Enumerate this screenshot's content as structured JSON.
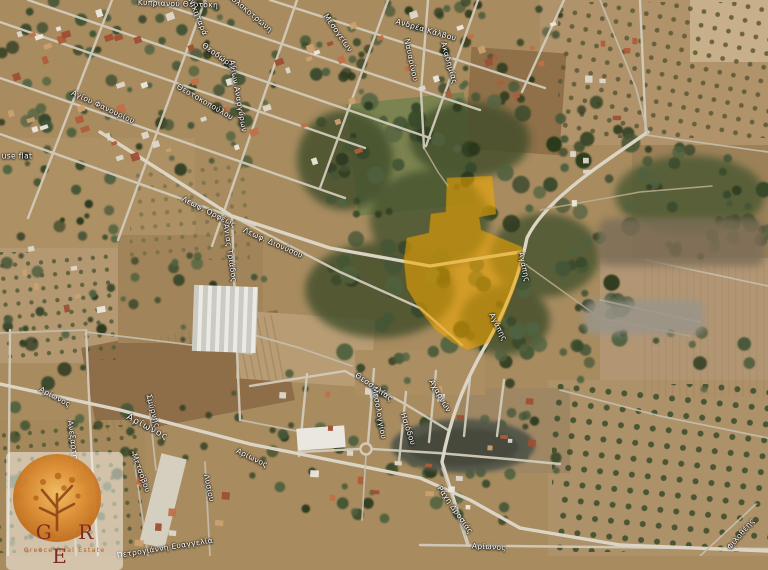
{
  "map": {
    "type": "satellite",
    "parcel": {
      "color": "#f2a800"
    },
    "street_labels": [
      {
        "text": "Κυπριανού Θεοτόκη",
        "x": 178,
        "y": 4,
        "rot": 2
      },
      {
        "text": "Νικηταρά",
        "x": 198,
        "y": 17,
        "rot": 68
      },
      {
        "text": "Κολοκοτρώνη",
        "x": 250,
        "y": 13,
        "rot": 40
      },
      {
        "text": "Μεσογείων",
        "x": 338,
        "y": 33,
        "rot": 55
      },
      {
        "text": "Ανδρέα Κάλβου",
        "x": 426,
        "y": 30,
        "rot": 16
      },
      {
        "text": "Ναυαρίνου",
        "x": 411,
        "y": 60,
        "rot": 78
      },
      {
        "text": "Ακαδημίας",
        "x": 449,
        "y": 63,
        "rot": 74
      },
      {
        "text": "Θεοδώρας",
        "x": 220,
        "y": 57,
        "rot": 36
      },
      {
        "text": "Θεοτοκοπούλου",
        "x": 205,
        "y": 102,
        "rot": 30
      },
      {
        "text": "Αγίου Φανουρίου",
        "x": 103,
        "y": 107,
        "rot": 25
      },
      {
        "text": "Αγίων Αναργύρων",
        "x": 238,
        "y": 96,
        "rot": 80
      },
      {
        "text": "use flat",
        "x": 17,
        "y": 156,
        "rot": 0
      },
      {
        "text": "Λεωφ. Ορφέως",
        "x": 209,
        "y": 212,
        "rot": 27
      },
      {
        "text": "Λεωφ. Διονύσου",
        "x": 273,
        "y": 243,
        "rot": 24
      },
      {
        "text": "Αγίας Τριάδος",
        "x": 230,
        "y": 253,
        "rot": 82
      },
      {
        "text": "Αγάπης",
        "x": 524,
        "y": 267,
        "rot": 78
      },
      {
        "text": "Αγάπης",
        "x": 498,
        "y": 327,
        "rot": 63
      },
      {
        "text": "Αρίωνος",
        "x": 55,
        "y": 397,
        "rot": 28
      },
      {
        "text": "Αρίωνος",
        "x": 147,
        "y": 428,
        "rot": 28,
        "major": true
      },
      {
        "text": "Αρίωνος",
        "x": 252,
        "y": 458,
        "rot": 26
      },
      {
        "text": "Ανεξαρτησίας",
        "x": 74,
        "y": 449,
        "rot": 82
      },
      {
        "text": "Σμύρνης",
        "x": 153,
        "y": 411,
        "rot": 75
      },
      {
        "text": "Μετσόβου",
        "x": 141,
        "y": 473,
        "rot": 70
      },
      {
        "text": "Λυσίου",
        "x": 209,
        "y": 488,
        "rot": 78
      },
      {
        "text": "Πετρογιάννη Ευαγγελία",
        "x": 165,
        "y": 548,
        "rot": -9
      },
      {
        "text": "Θεσσαλίας",
        "x": 374,
        "y": 387,
        "rot": 35
      },
      {
        "text": "Μεσολογγίου",
        "x": 379,
        "y": 413,
        "rot": 80
      },
      {
        "text": "Ησιόδου",
        "x": 408,
        "y": 429,
        "rot": 72
      },
      {
        "text": "Αχαρνών",
        "x": 440,
        "y": 396,
        "rot": 60
      },
      {
        "text": "Ράχη Δροσιάς",
        "x": 455,
        "y": 510,
        "rot": 55
      },
      {
        "text": "Αρίωνος",
        "x": 489,
        "y": 547,
        "rot": 3
      },
      {
        "text": "Φιλοθέης",
        "x": 741,
        "y": 534,
        "rot": -50
      }
    ],
    "watermark": {
      "initials": "G R E",
      "subtitle": "Greece Real Estate"
    }
  }
}
